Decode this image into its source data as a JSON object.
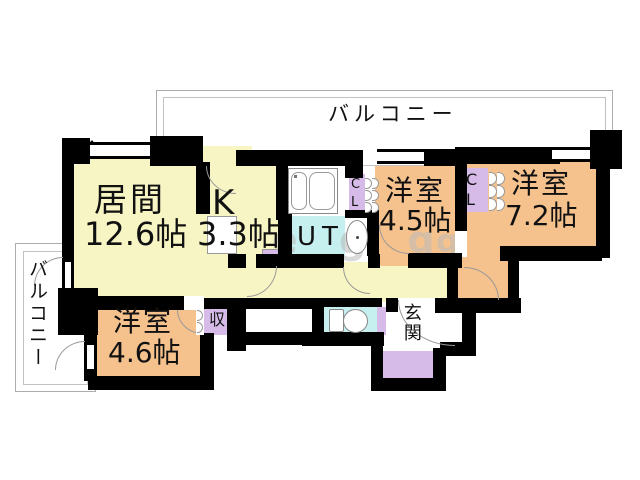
{
  "balcony_top": {
    "label": "バルコニー"
  },
  "balcony_left": {
    "label": "バルコニー"
  },
  "rooms": {
    "living": {
      "name": "居間",
      "size": "12.6帖"
    },
    "kitchen": {
      "name": "K",
      "size": "3.3帖"
    },
    "west_45": {
      "name": "洋室",
      "size": "4.5帖"
    },
    "west_72": {
      "name": "洋室",
      "size": "7.2帖"
    },
    "west_46": {
      "name": "洋室",
      "size": "4.6帖"
    },
    "utility": {
      "label": "UT"
    },
    "closet_a": {
      "label": "C\nL"
    },
    "closet_b": {
      "label": "C\nL"
    },
    "storage": {
      "label": "収"
    },
    "entrance": {
      "label": "玄関"
    }
  },
  "watermark": {
    "text": "e g g",
    "extra": "g"
  },
  "colors": {
    "floor_yellow": "#F8F5C4",
    "room_orange": "#F5C28E",
    "wet_cyan": "#C6EFEF",
    "closet_purple": "#D6BBE9",
    "wall": "#000000",
    "balcony_line": "#ACACAC"
  }
}
